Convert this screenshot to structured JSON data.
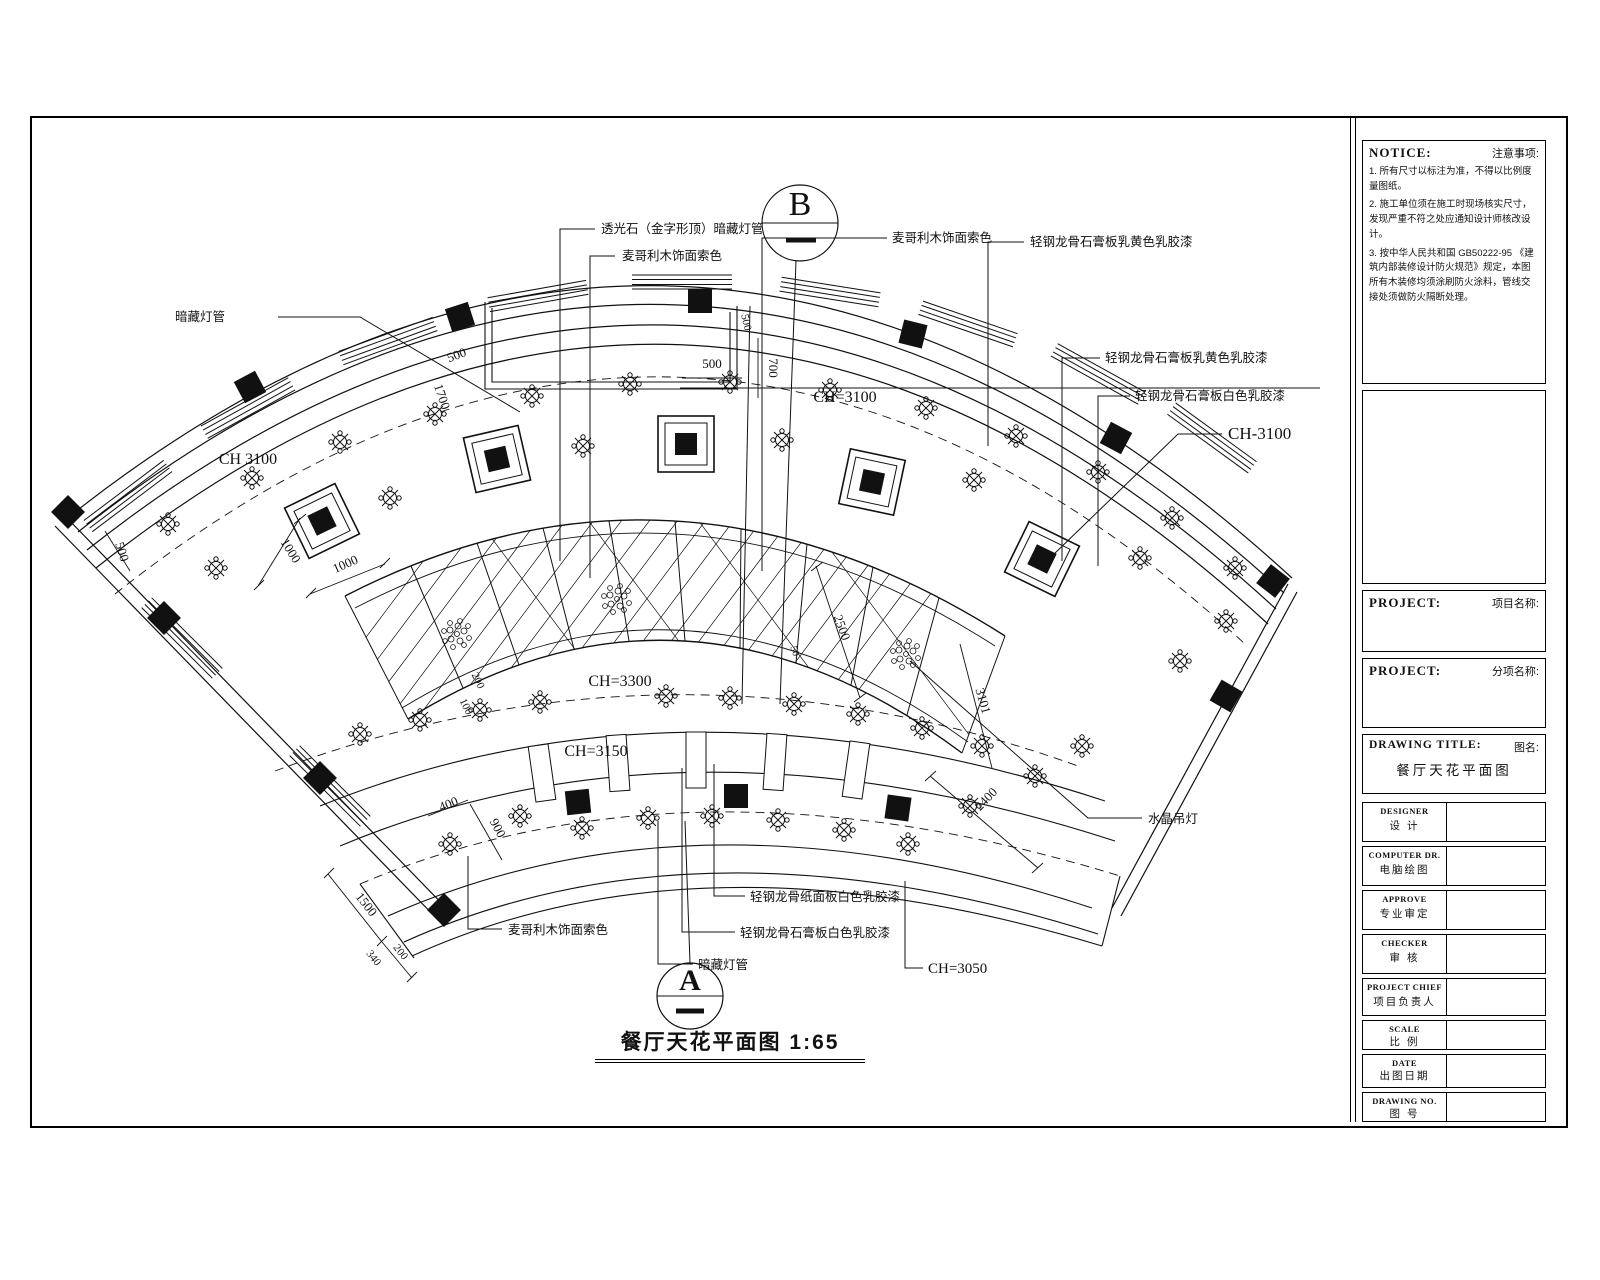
{
  "sheet": {
    "drawing_title": "餐厅天花平面图",
    "drawing_scale": "1:65",
    "section_b": "B",
    "section_a": "A"
  },
  "annotations": {
    "cove_light_top": "透光石（金字形顶）暗藏灯管",
    "wood_veneer_top": "麦哥利木饰面索色",
    "wood_veneer_right": "麦哥利木饰面索色",
    "gypsum_yellow_1": "轻钢龙骨石膏板乳黄色乳胶漆",
    "gypsum_yellow_2": "轻钢龙骨石膏板乳黄色乳胶漆",
    "gypsum_white_right": "轻钢龙骨石膏板白色乳胶漆",
    "hidden_lamp_left": "暗藏灯管",
    "crystal_chandelier": "水晶吊灯",
    "wood_veneer_bottom": "麦哥利木饰面索色",
    "gypsum_white_bottom_1": "轻钢龙骨纸面板白色乳胶漆",
    "gypsum_white_bottom_2": "轻钢龙骨石膏板白色乳胶漆",
    "hidden_lamp_bottom": "暗藏灯管"
  },
  "ceiling_heights": {
    "ch_left": "CH 3100",
    "ch_mid_top": "CH=3100",
    "ch_right": "CH-3100",
    "ch_center": "CH=3300",
    "ch_lower": "CH=3150",
    "ch_bottom": "CH=3050"
  },
  "dimensions": [
    "500",
    "1700",
    "500",
    "700",
    "500",
    "1000",
    "1000",
    "500",
    "200",
    "100",
    "400",
    "900",
    "1500",
    "340",
    "200",
    "2500",
    "3101",
    "2400",
    "50"
  ],
  "titleblock": {
    "notice_en": "NOTICE:",
    "notice_zh": "注意事项:",
    "notice_items": [
      "1. 所有尺寸以标注为准，不得以比例度量图纸。",
      "2. 施工单位须在施工时现场核实尺寸，发现严重不符之处应通知设计师核改设计。",
      "3. 按中华人民共和国 GB50222-95 《建筑内部装修设计防火规范》规定，本图所有木装修均须涂刷防火涂料，管线交接处须做防火隔断处理。"
    ],
    "project1_en": "PROJECT:",
    "project1_zh": "项目名称:",
    "project2_en": "PROJECT:",
    "project2_zh": "分项名称:",
    "drawing_title_en": "DRAWING TITLE:",
    "drawing_title_zh": "图名:",
    "drawing_title_value": "餐厅天花平面图",
    "rows": [
      {
        "en": "DESIGNER",
        "zh": "设 计"
      },
      {
        "en": "COMPUTER DR.",
        "zh": "电脑绘图"
      },
      {
        "en": "APPROVE",
        "zh": "专业审定"
      },
      {
        "en": "CHECKER",
        "zh": "审 核"
      },
      {
        "en": "PROJECT CHIEF",
        "zh": "项目负责人"
      },
      {
        "en": "SCALE",
        "zh": "比 例"
      },
      {
        "en": "DATE",
        "zh": "出图日期"
      },
      {
        "en": "DRAWING NO.",
        "zh": "图 号"
      }
    ]
  }
}
